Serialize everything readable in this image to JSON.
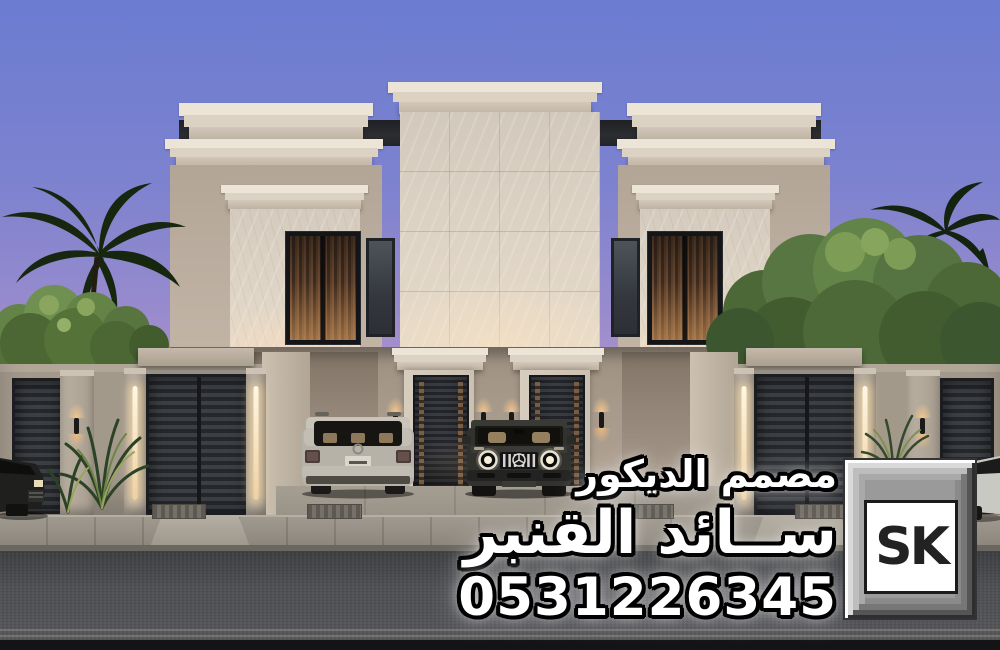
{
  "overlay": {
    "profession": "مصمم الديكور",
    "name": "ســائد القنبر",
    "phone": "0531226345"
  },
  "logo": {
    "text": "SK"
  },
  "palette": {
    "sky_top": "#6b7cd1",
    "sky_horizon": "#ecb8c8",
    "stucco": "#b7aa9c",
    "cornice_cream": "#e8e0d1",
    "marble": "#ddd3c5",
    "roof_shadow": "#26282b",
    "gate_metal": "#2b2e32",
    "led_glow": "#ffe9c0",
    "street_asphalt": "#4e4f53",
    "text_fill": "#ffffff",
    "text_outline": "#000000"
  }
}
